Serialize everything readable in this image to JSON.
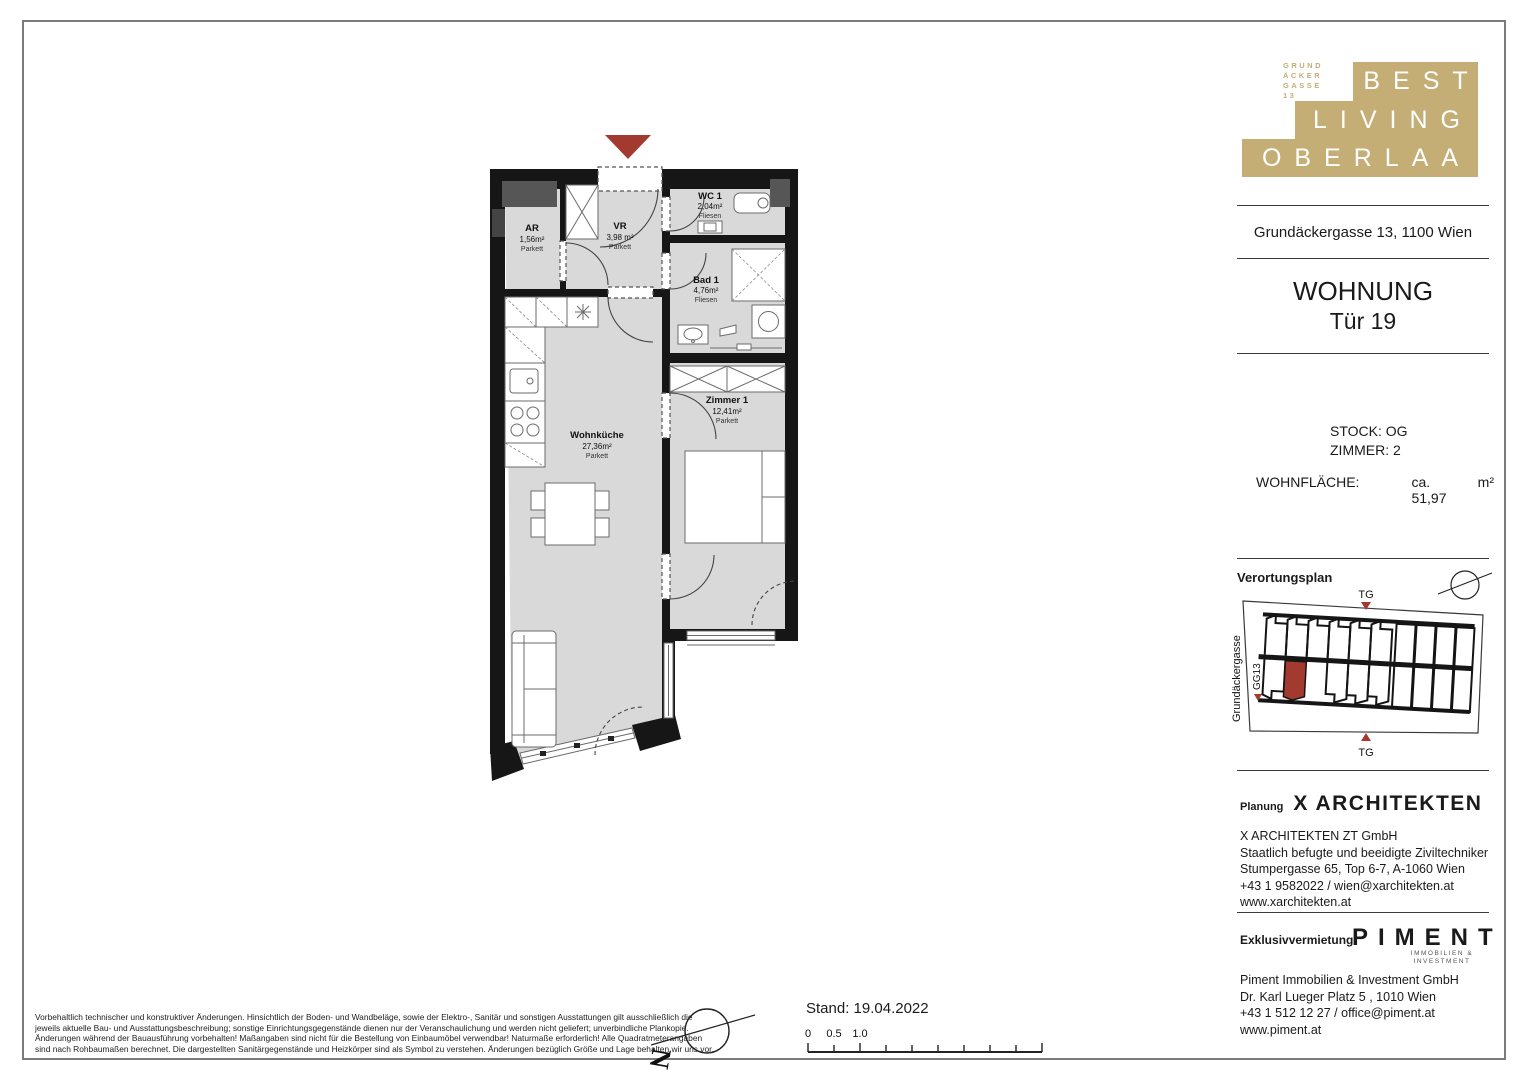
{
  "sheet": {
    "logo": {
      "rows": [
        "BEST",
        "LIVING",
        "OBERLAA"
      ],
      "side_lines": [
        "GRUND",
        "ÄCKER",
        "GASSE",
        "13"
      ],
      "gold": "#c5ad76"
    },
    "address": "Grundäckergasse 13, 1100 Wien",
    "unit": {
      "title": "WOHNUNG",
      "door": "Tür 19",
      "stock": "STOCK: OG",
      "rooms": "ZIMMER: 2",
      "area_label": "WOHNFLÄCHE:",
      "area_value": "ca. 51,97",
      "area_unit": "m²"
    }
  },
  "floorplan": {
    "entrance_color": "#a23a30",
    "rooms": [
      {
        "name": "AR",
        "area": "1,56m²",
        "floor": "Parkett"
      },
      {
        "name": "VR",
        "area": "3,98 m²",
        "floor": "Parkett"
      },
      {
        "name": "WC 1",
        "area": "2,04m²",
        "floor": "Fliesen"
      },
      {
        "name": "Bad 1",
        "area": "4,76m²",
        "floor": "Fliesen"
      },
      {
        "name": "Zimmer 1",
        "area": "12,41m²",
        "floor": "Parkett"
      },
      {
        "name": "Wohnküche",
        "area": "27,36m²",
        "floor": "Parkett"
      }
    ]
  },
  "verortung": {
    "title": "Verortungsplan",
    "street": "Grundäckergasse",
    "gg": "GG13",
    "tg_top": "TG",
    "tg_bottom": "TG",
    "highlight": "#a23a30"
  },
  "planung": {
    "label": "Planung",
    "firm": "X ARCHITEKTEN",
    "lines": [
      "X ARCHITEKTEN ZT GmbH",
      "Staatlich befugte und beeidigte Ziviltechniker",
      "Stumpergasse 65, Top 6-7, A-1060 Wien",
      "+43 1 9582022 / wien@xarchitekten.at",
      "www.xarchitekten.at"
    ]
  },
  "vermietung": {
    "label": "Exklusivvermietung",
    "firm": "PIMENT",
    "firm_sub": [
      "IMMOBILIEN &",
      "INVESTMENT"
    ],
    "lines": [
      "Piment Immobilien & Investment GmbH",
      "Dr. Karl Lueger Platz 5 , 1010 Wien",
      "+43 1 512 12 27 / office@piment.at",
      "www.piment.at"
    ]
  },
  "footer": {
    "disclaimer_lines": [
      "Vorbehaltlich technischer und konstruktiver Änderungen. Hinsichtlich der Boden- und Wandbeläge, sowie der Elektro-, Sanitär und sonstigen Ausstattungen gilt ausschließlich die",
      "jeweils aktuelle Bau- und Ausstattungsbeschreibung; sonstige Einrichtungsgegenstände dienen nur der Veranschaulichung und werden nicht geliefert; unverbindliche Plankopie.",
      "Änderungen während der Bauausführung vorbehalten! Maßangaben sind nicht für die Bestellung von Einbaumöbel verwendbar! Naturmaße erforderlich! Alle Quadratmeterangaben",
      "sind nach Rohbaumaßen berechnet. Die dargestellten Sanitärgegenstände und Heizkörper sind als Symbol zu verstehen. Änderungen bezüglich Größe und Lage behalten wir uns vor."
    ],
    "stand": "Stand: 19.04.2022",
    "scale_ticks": [
      "0",
      "0.5",
      "1.0"
    ],
    "north": "N"
  }
}
